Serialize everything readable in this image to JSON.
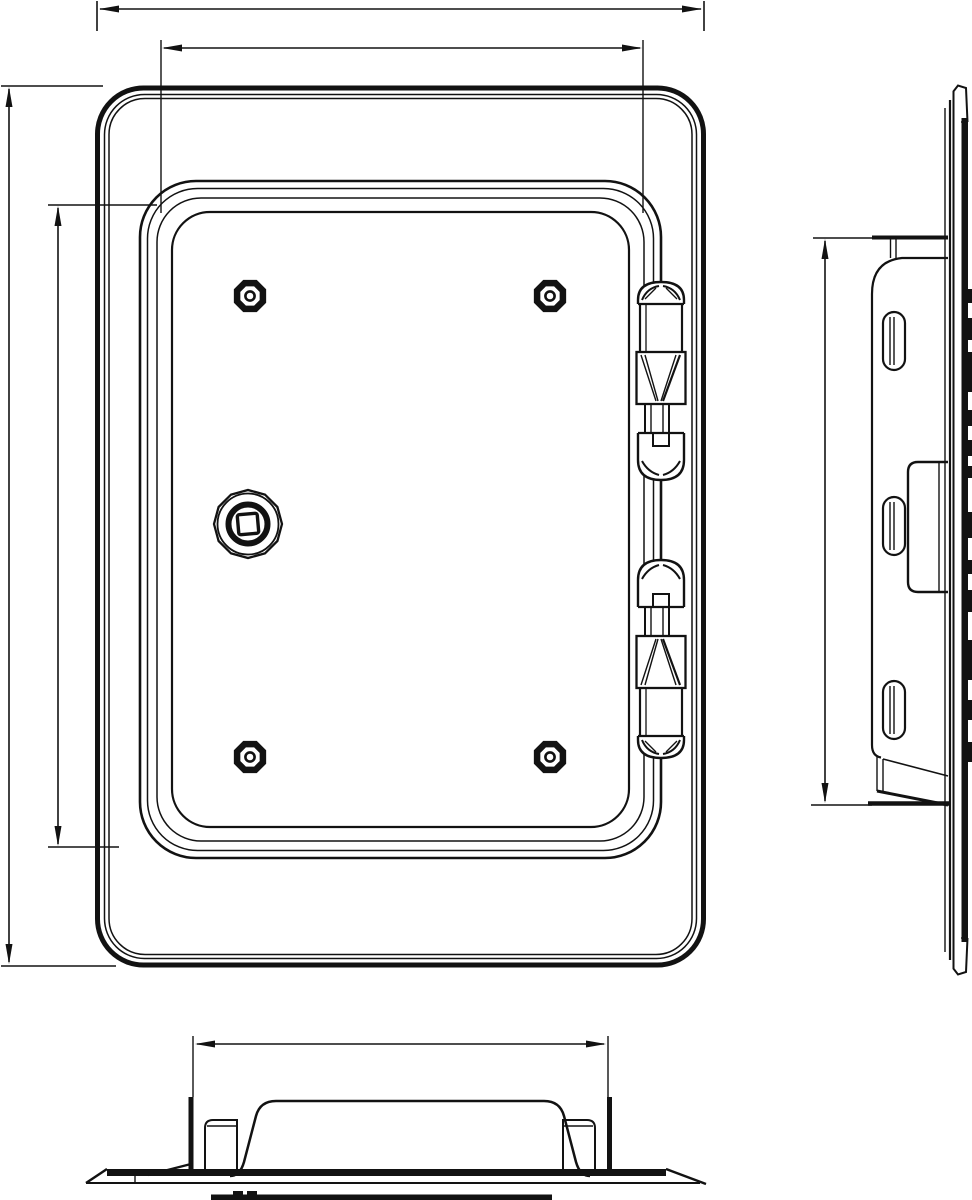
{
  "colors": {
    "background": "#ffffff",
    "ink": "#121212"
  },
  "drawing": {
    "kind": "technical line drawing",
    "subject": "framed access door / inspection hatch",
    "views": [
      {
        "id": "front",
        "label": "front view",
        "features": [
          "outer frame",
          "raised door panel",
          "4 rivet screws",
          "square-drive lock",
          "2 hinges"
        ]
      },
      {
        "id": "side",
        "label": "side profile view",
        "features": [
          "mounting flange",
          "bracket with 3 slotted holes",
          "lock housing"
        ]
      },
      {
        "id": "bottom",
        "label": "bottom profile view",
        "features": [
          "flange plate",
          "raised door dome",
          "2 mounting clips"
        ]
      }
    ],
    "dimension_lines": [
      {
        "id": "front-overall-width",
        "view": "front",
        "axis": "horizontal",
        "value_label": ""
      },
      {
        "id": "front-door-width",
        "view": "front",
        "axis": "horizontal",
        "value_label": ""
      },
      {
        "id": "front-overall-height",
        "view": "front",
        "axis": "vertical",
        "value_label": ""
      },
      {
        "id": "front-door-height",
        "view": "front",
        "axis": "vertical",
        "value_label": ""
      },
      {
        "id": "side-bracket-height",
        "view": "side",
        "axis": "vertical",
        "value_label": ""
      },
      {
        "id": "bottom-opening-width",
        "view": "bottom",
        "axis": "horizontal",
        "value_label": ""
      }
    ]
  }
}
